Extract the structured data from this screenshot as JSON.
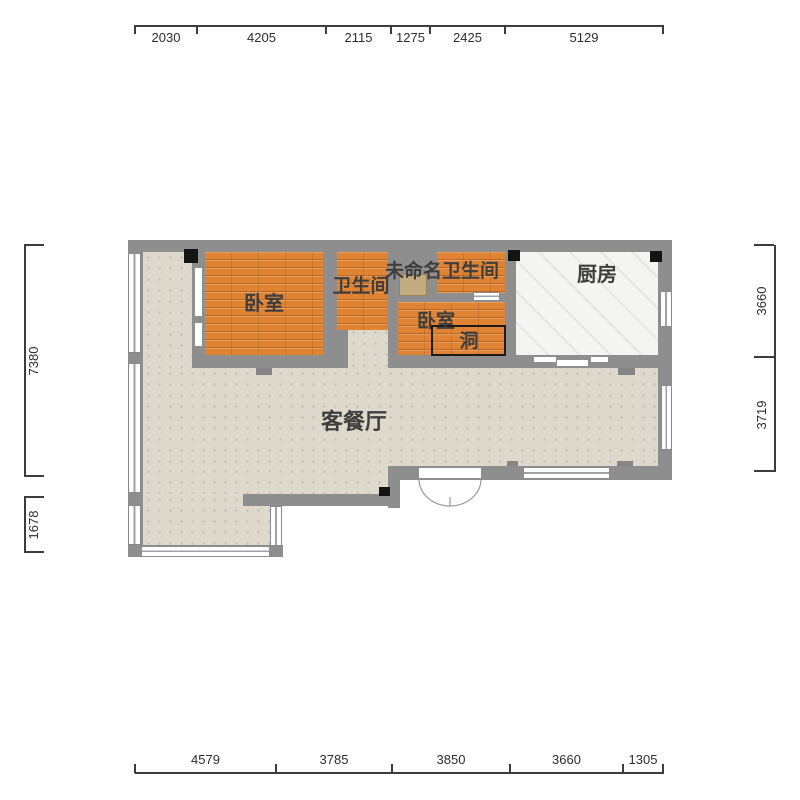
{
  "plan": {
    "title": "apartment-floor-plan",
    "rooms": {
      "bedroom1": {
        "label": "卧室"
      },
      "bathroom1": {
        "label": "卫生间"
      },
      "unnamed_bathroom": {
        "label": "未命名卫生间"
      },
      "kitchen": {
        "label": "厨房"
      },
      "bedroom2": {
        "label": "卧室"
      },
      "hole": {
        "label": "洞"
      },
      "living_dining": {
        "label": "客餐厅"
      }
    },
    "dimensions": {
      "top": [
        "2030",
        "4205",
        "2115",
        "1275",
        "2425",
        "5129"
      ],
      "bottom": [
        "4579",
        "3785",
        "3850",
        "3660",
        "1305"
      ],
      "left": [
        "7380",
        "1678"
      ],
      "right": [
        "3660",
        "3719"
      ]
    },
    "colors": {
      "wall": "#8e8e8e",
      "bedroom_floor": "#e08434",
      "living_floor": "#ded9cc",
      "kitchen_floor": "#f4f4f2",
      "window": "#ffffff",
      "column_marker": "#141414",
      "door_leaf": "#c2aa81",
      "dimension_text": "#2d2d2d"
    }
  }
}
